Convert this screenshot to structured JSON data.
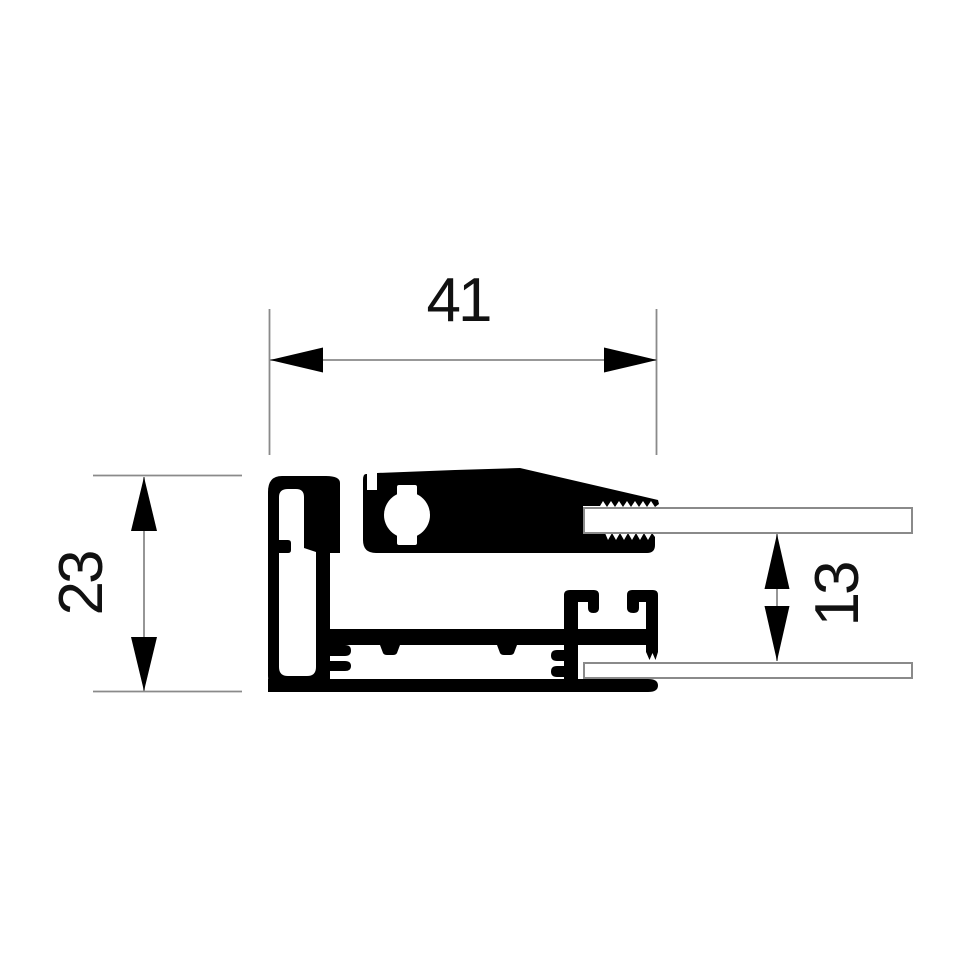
{
  "figure": {
    "type": "technical-cross-section-drawing",
    "dimensions": [
      {
        "id": "overall-width",
        "label": "41",
        "orientation": "horizontal"
      },
      {
        "id": "overall-height",
        "label": "23",
        "orientation": "vertical"
      },
      {
        "id": "panel-gap",
        "label": "13",
        "orientation": "vertical"
      }
    ],
    "colors": {
      "profile_fill": "#000000",
      "dimension_line": "#8a8a8a",
      "panel_outline": "#8a8a8a",
      "label_text": "#111111",
      "background": "#ffffff"
    }
  }
}
